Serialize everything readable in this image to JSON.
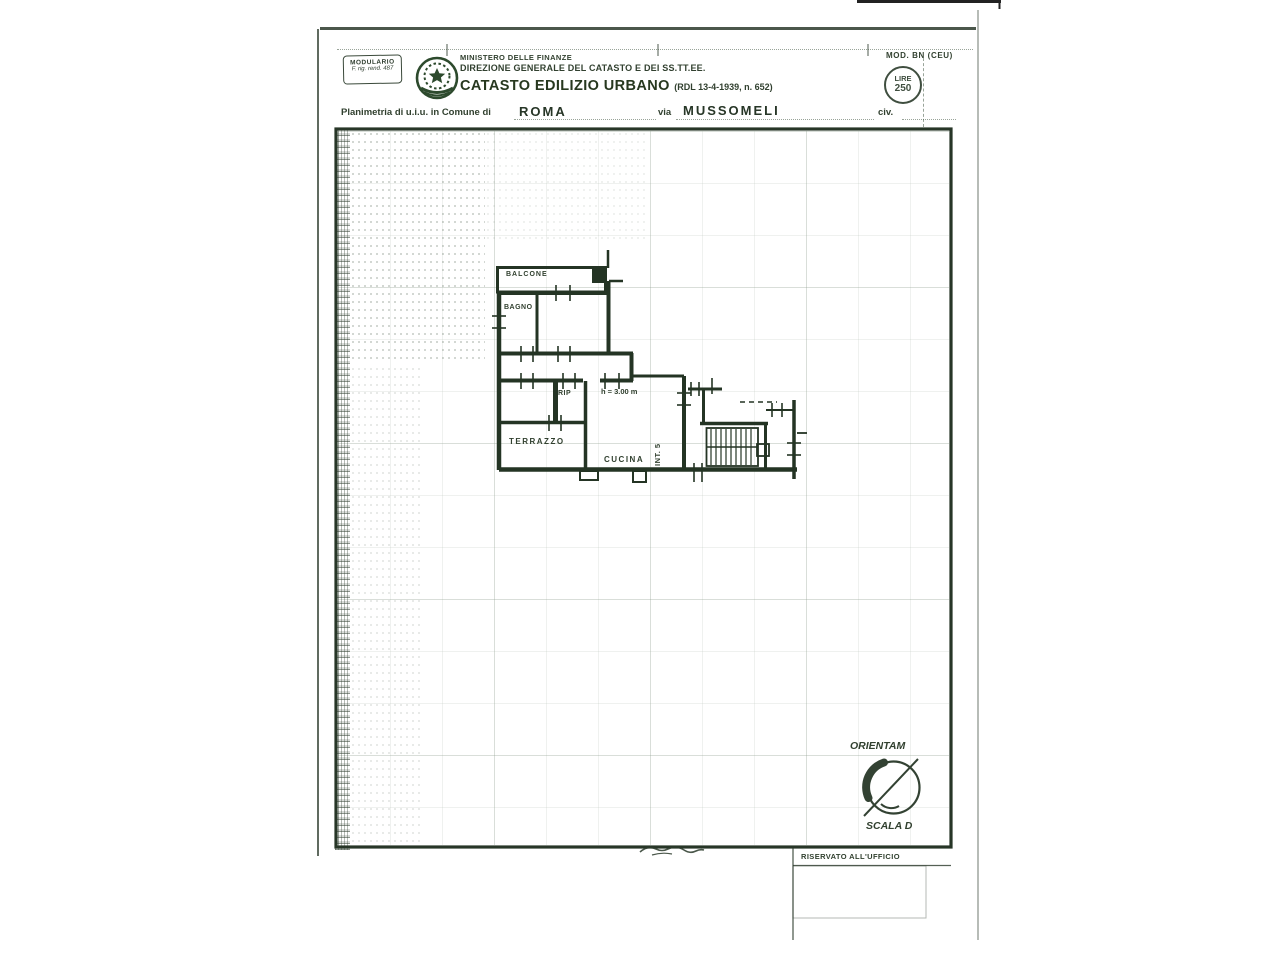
{
  "header": {
    "modulario_line1": "MODULARIO",
    "modulario_line2": "F. rig. rend. 487",
    "ministry": "MINISTERO DELLE FINANZE",
    "directorate": "DIREZIONE GENERALE DEL CATASTO E DEI SS.TT.EE.",
    "registry_title": "CATASTO EDILIZIO URBANO",
    "registry_law": "(RDL 13-4-1939, n. 652)",
    "mod_code": "MOD. BN (CEU)",
    "stamp_currency": "LIRE",
    "stamp_amount": "250"
  },
  "form_line": {
    "label_prefix": "Planimetria di u.i.u. in Comune di",
    "comune_value": "ROMA",
    "via_label": "via",
    "via_value": "MUSSOMELI",
    "civ_label": "civ."
  },
  "floor_plan": {
    "rooms": [
      "BALCONE",
      "BAGNO",
      "RIP",
      "TERRAZZO",
      "CUCINA"
    ],
    "unit_label": "INT. 5",
    "height_note": "h = 3.00 m"
  },
  "footer": {
    "orientation_label": "ORIENTAM",
    "scale_label": "SCALA D",
    "office_box_label": "RISERVATO ALL'UFFICIO"
  },
  "colors": {
    "ink": "#2e3d2e",
    "emblem_green": "#2d4a2d",
    "paper": "#ffffff"
  }
}
